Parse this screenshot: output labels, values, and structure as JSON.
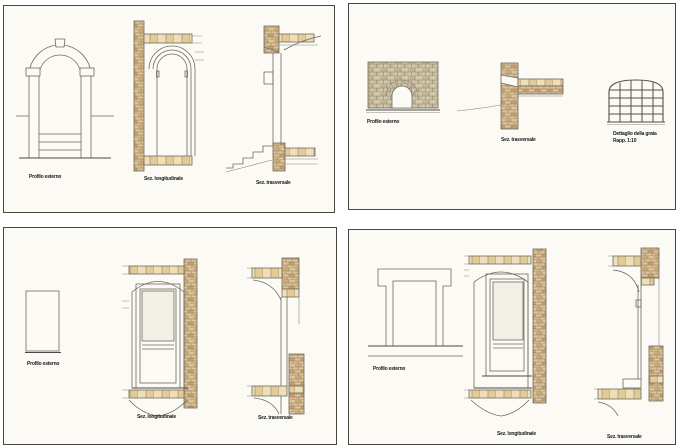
{
  "colors": {
    "page_background": "#ffffff",
    "sheet_background": "#fbfaf4",
    "sheet_border": "#49453f",
    "line_color": "#6f6a60",
    "brick_fill": "#dbc39a",
    "brick_dark": "#c5a06c",
    "stone_fill": "#eedfb8",
    "mortar_joint": "#8d7b5c"
  },
  "panels": {
    "top_left": {
      "labels": {
        "elevation": "Profilo esterno",
        "longitudinal": "Sez. longitudinale",
        "transverse": "Sez. trasversale"
      }
    },
    "top_right": {
      "labels": {
        "elevation": "Profilo esterno",
        "transverse": "Sez. trasversale",
        "detail_line1": "Dettaglio della grata",
        "detail_line2": "Rapp. 1:10"
      }
    },
    "bottom_left": {
      "labels": {
        "elevation": "Profilo esterno",
        "longitudinal": "Sez. longitudinale",
        "transverse": "Sez. trasversale"
      }
    },
    "bottom_right": {
      "labels": {
        "elevation": "Profilo esterno",
        "longitudinal": "Sez. longitudinale",
        "transverse": "Sez. trasversale"
      }
    }
  }
}
